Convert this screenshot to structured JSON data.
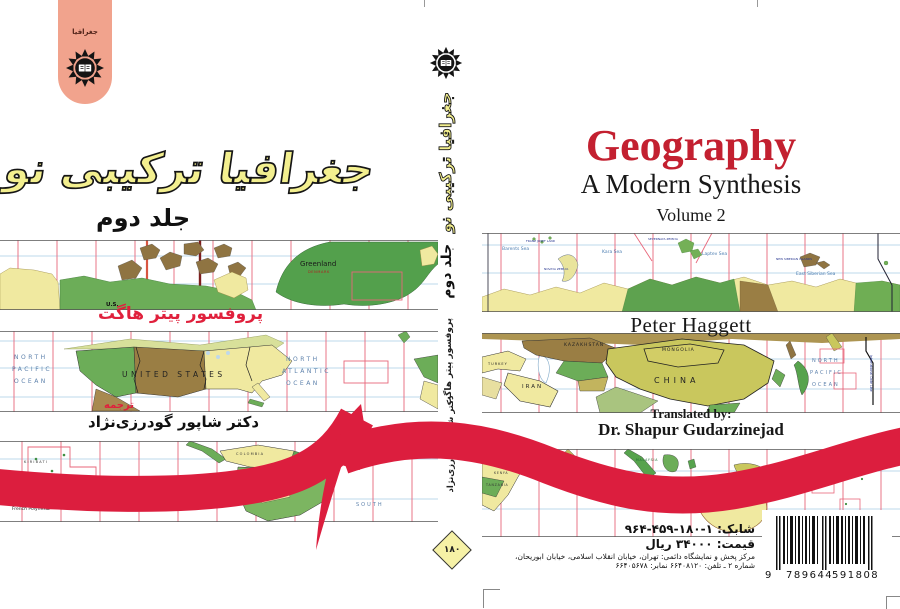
{
  "back_cover": {
    "tab_label": "جغرافیا",
    "title": "جغرافیا ترکیبی نو",
    "volume": "جلد دوم",
    "author": "پروفسور پیتر هاگت",
    "translator_label": "ترجمه",
    "translator": "دکتر شاپور گودرزی‌نژاد",
    "map1": {
      "greenland": "Greenland",
      "denmark": "DENMARK",
      "us": "U.S."
    },
    "map2": {
      "np1": "NORTH",
      "np2": "PACIFIC",
      "np3": "OCEAN",
      "country": "UNITED STATES",
      "na1": "NORTH",
      "na2": "ATLANTIC",
      "na3": "OCEAN"
    },
    "map3": {
      "kiribati": "KIRIBATI",
      "french_polynesia": "French Polynesia",
      "ocean": "OCEAN",
      "colombia": "COLOMBIA",
      "brazil": "BRAZIL",
      "south": "SOUTH"
    }
  },
  "spine": {
    "title": "جغرافیا ترکیبی نو",
    "volume": "جلد دوم",
    "author": "پروفسور پیتر هاگت",
    "translator_label": "ترجمه",
    "translator": "دکتر شاپور گودرزی‌نژاد",
    "badge": "۱۸۰"
  },
  "front_cover": {
    "title": "Geography",
    "subtitle": "A Modern Synthesis",
    "volume": "Volume 2",
    "author": "Peter Haggett",
    "translated_by_label": "Translated by:",
    "translator": "Dr. Shapur Gudarzinejad",
    "map1": {
      "barents": "Barents Sea",
      "franz": "FRANZ JOSEF LAND",
      "novaya": "NOVAYA ZEMLYA",
      "kara": "Kara Sea",
      "severnaya": "SEVERNAYA ZEMLYA",
      "laptev": "Laptev Sea",
      "new_siberian": "NEW SIBERIAN ISLANDS",
      "east_siberian": "East Siberian Sea"
    },
    "map2": {
      "turkey": "TURKEY",
      "iran": "IRAN",
      "kazakhstan": "KAZAKHSTAN",
      "mongolia": "MONGOLIA",
      "china": "CHINA",
      "np1": "NORTH",
      "np2": "PACIFIC",
      "np3": "OCEAN",
      "date_line": "International Date Line"
    },
    "map3": {
      "kenya": "KENYA",
      "somalia": "SOMALIA",
      "tanzania": "TANZANIA",
      "malaysia": "MALAYSIA"
    }
  },
  "footer": {
    "isbn_fa": "شابک: ۱-۱۸۰-۴۵۹-۹۶۴",
    "price": "قیمت: ۳۴۰۰۰ ریال",
    "address1": "مرکز پخش و نمایشگاه دائمی: تهران، خیابان انقلاب اسلامی، خیابان ابوریحان،",
    "address2": "شماره ۲ ـ تلفن: ۶۶۴۰۸۱۲۰ نمابر: ۶۶۴۰۵۶۷۸",
    "barcode": {
      "left": "9",
      "group1": "789644",
      "group2": "591808"
    }
  },
  "colors": {
    "accent_red": "#DC1E3E",
    "title_red": "#C32030",
    "title_yellow": "#F3EF8F",
    "tab_pink": "#F1A38D"
  }
}
